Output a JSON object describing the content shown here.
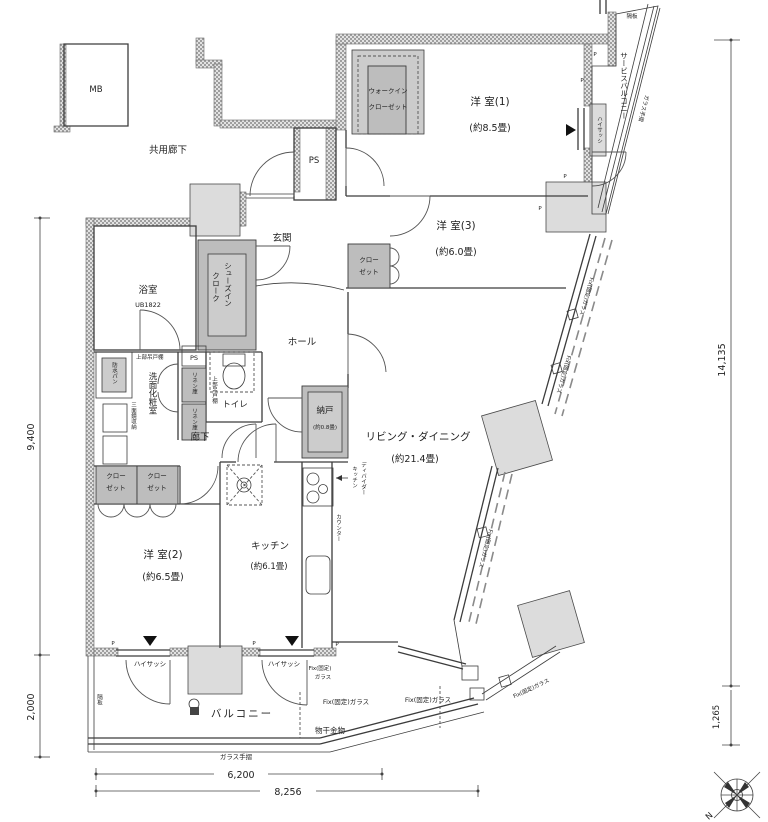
{
  "colors": {
    "wall_hatch": "#9f9f9f",
    "closet_fill": "#bdbdbd",
    "slab_fill": "#dcdcdc",
    "line": "#3c3c3c"
  },
  "rooms": {
    "common_corridor": "共用廊下",
    "entrance": "玄関",
    "hall": "ホール",
    "corridor": "廊下",
    "bathroom": "浴室",
    "bathroom_model": "UB1822",
    "washroom": "洗面化粧室",
    "toilet": "トイレ",
    "room1": "洋 室(1)",
    "room1_size": "(約8.5畳)",
    "room2": "洋 室(2)",
    "room2_size": "(約6.5畳)",
    "room3": "洋 室(3)",
    "room3_size": "(約6.0畳)",
    "living": "リビング・ダイニング",
    "living_size": "(約21.4畳)",
    "kitchen": "キッチン",
    "kitchen_size": "(約6.1畳)",
    "storage_room": "納戸",
    "storage_room_size": "(約0.8畳)",
    "balcony": "バルコニー",
    "service_balcony": "サービスバルコニー"
  },
  "storage": {
    "wic_line1": "ウォークイン",
    "wic_line2": "クローゼット",
    "sic_line1": "シューズイン",
    "sic_line2": "クローク",
    "closet_line1": "クロー",
    "closet_line2": "ゼット",
    "linen": "リネン庫",
    "mirror_cabinet": "三面鏡収納",
    "upper_cabinet": "上部吊戸棚"
  },
  "fixtures": {
    "mb": "MB",
    "ps": "PS",
    "waterproof_pan": "防水パン",
    "counter": "カウンター",
    "divider_line1": "キッチン",
    "divider_line2": "ディバイダー",
    "high_sash": "ハイサッシ",
    "fix_glass": "Fix(固定)ガラス",
    "fix_glass_l1": "Fix(固定)",
    "fix_glass_l2": "ガラス",
    "laundry_hook": "物干金物",
    "glass_rail": "ガラス手摺",
    "partition": "隔板",
    "pillar": "P"
  },
  "dimensions": {
    "left_upper": "9,400",
    "left_lower": "2,000",
    "right_main": "14,135",
    "right_lower": "1,265",
    "bottom_inner": "6,200",
    "bottom_outer": "8,256"
  },
  "compass": {
    "north": "N"
  }
}
